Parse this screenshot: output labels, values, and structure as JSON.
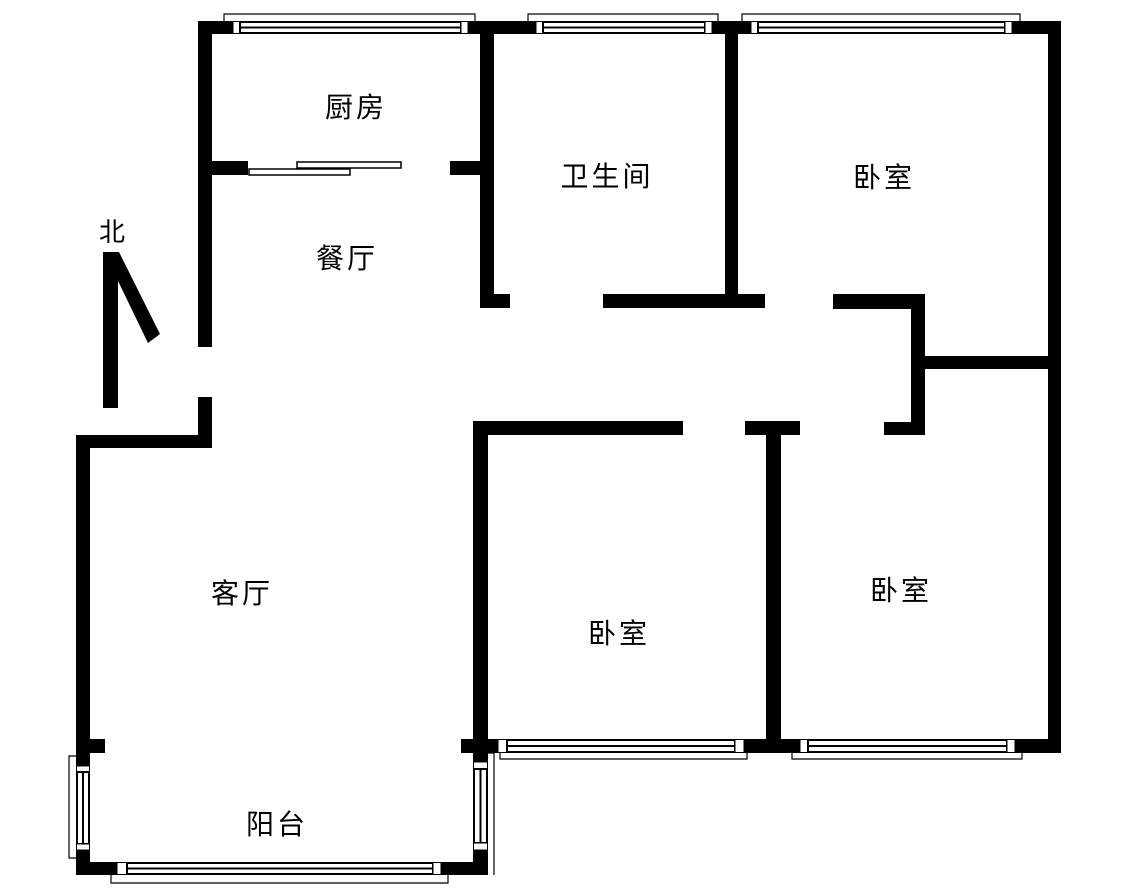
{
  "colors": {
    "wall": "#000000",
    "background": "#ffffff",
    "text": "#000000"
  },
  "compass": {
    "label": "北"
  },
  "rooms": {
    "kitchen": {
      "label": "厨房"
    },
    "dining": {
      "label": "餐厅"
    },
    "bathroom": {
      "label": "卫生间"
    },
    "bedroom_top_right": {
      "label": "卧室"
    },
    "bedroom_middle": {
      "label": "卧室"
    },
    "bedroom_bottom_right": {
      "label": "卧室"
    },
    "living_room": {
      "label": "客厅"
    },
    "balcony": {
      "label": "阳台"
    }
  }
}
